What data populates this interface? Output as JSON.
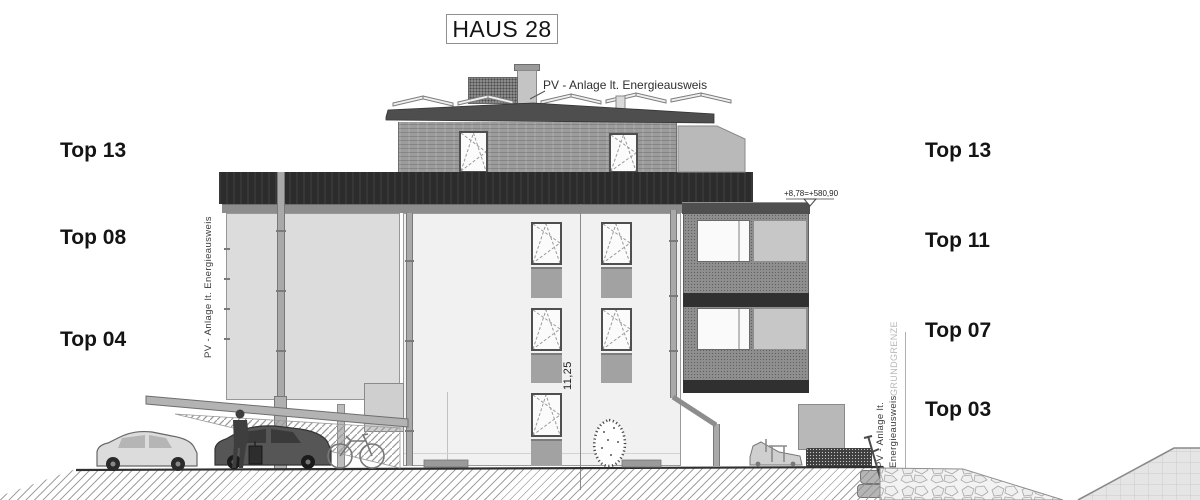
{
  "title": "HAUS 28",
  "labels_left": [
    {
      "text": "Top 13"
    },
    {
      "text": "Top 08"
    },
    {
      "text": "Top 04"
    }
  ],
  "labels_right": [
    {
      "text": "Top 13"
    },
    {
      "text": "Top 11"
    },
    {
      "text": "Top 07"
    },
    {
      "text": "Top 03"
    }
  ],
  "annotations": {
    "pv_roof": "PV - Anlage lt. Energieausweis",
    "pv_left_vertical": "PV - Anlage lt. Energieausweis",
    "pv_right_line1": "PV - Anlage lt.",
    "pv_right_line2": "Energieausweis",
    "boundary": "GRUNDGRENZE",
    "level_mark": "+8,78=+580,90",
    "height_dimension": "11,25"
  },
  "colors": {
    "attic_band": "#2c2c2c",
    "roof_slab": "#4e4e4e",
    "facade": "#f1f1f1",
    "penthouse_wall": "#9c9c9c",
    "balcony_wall": "#8f8f8f",
    "spandrel": "#a2a2a2",
    "ground_line": "#2f2f2f"
  }
}
